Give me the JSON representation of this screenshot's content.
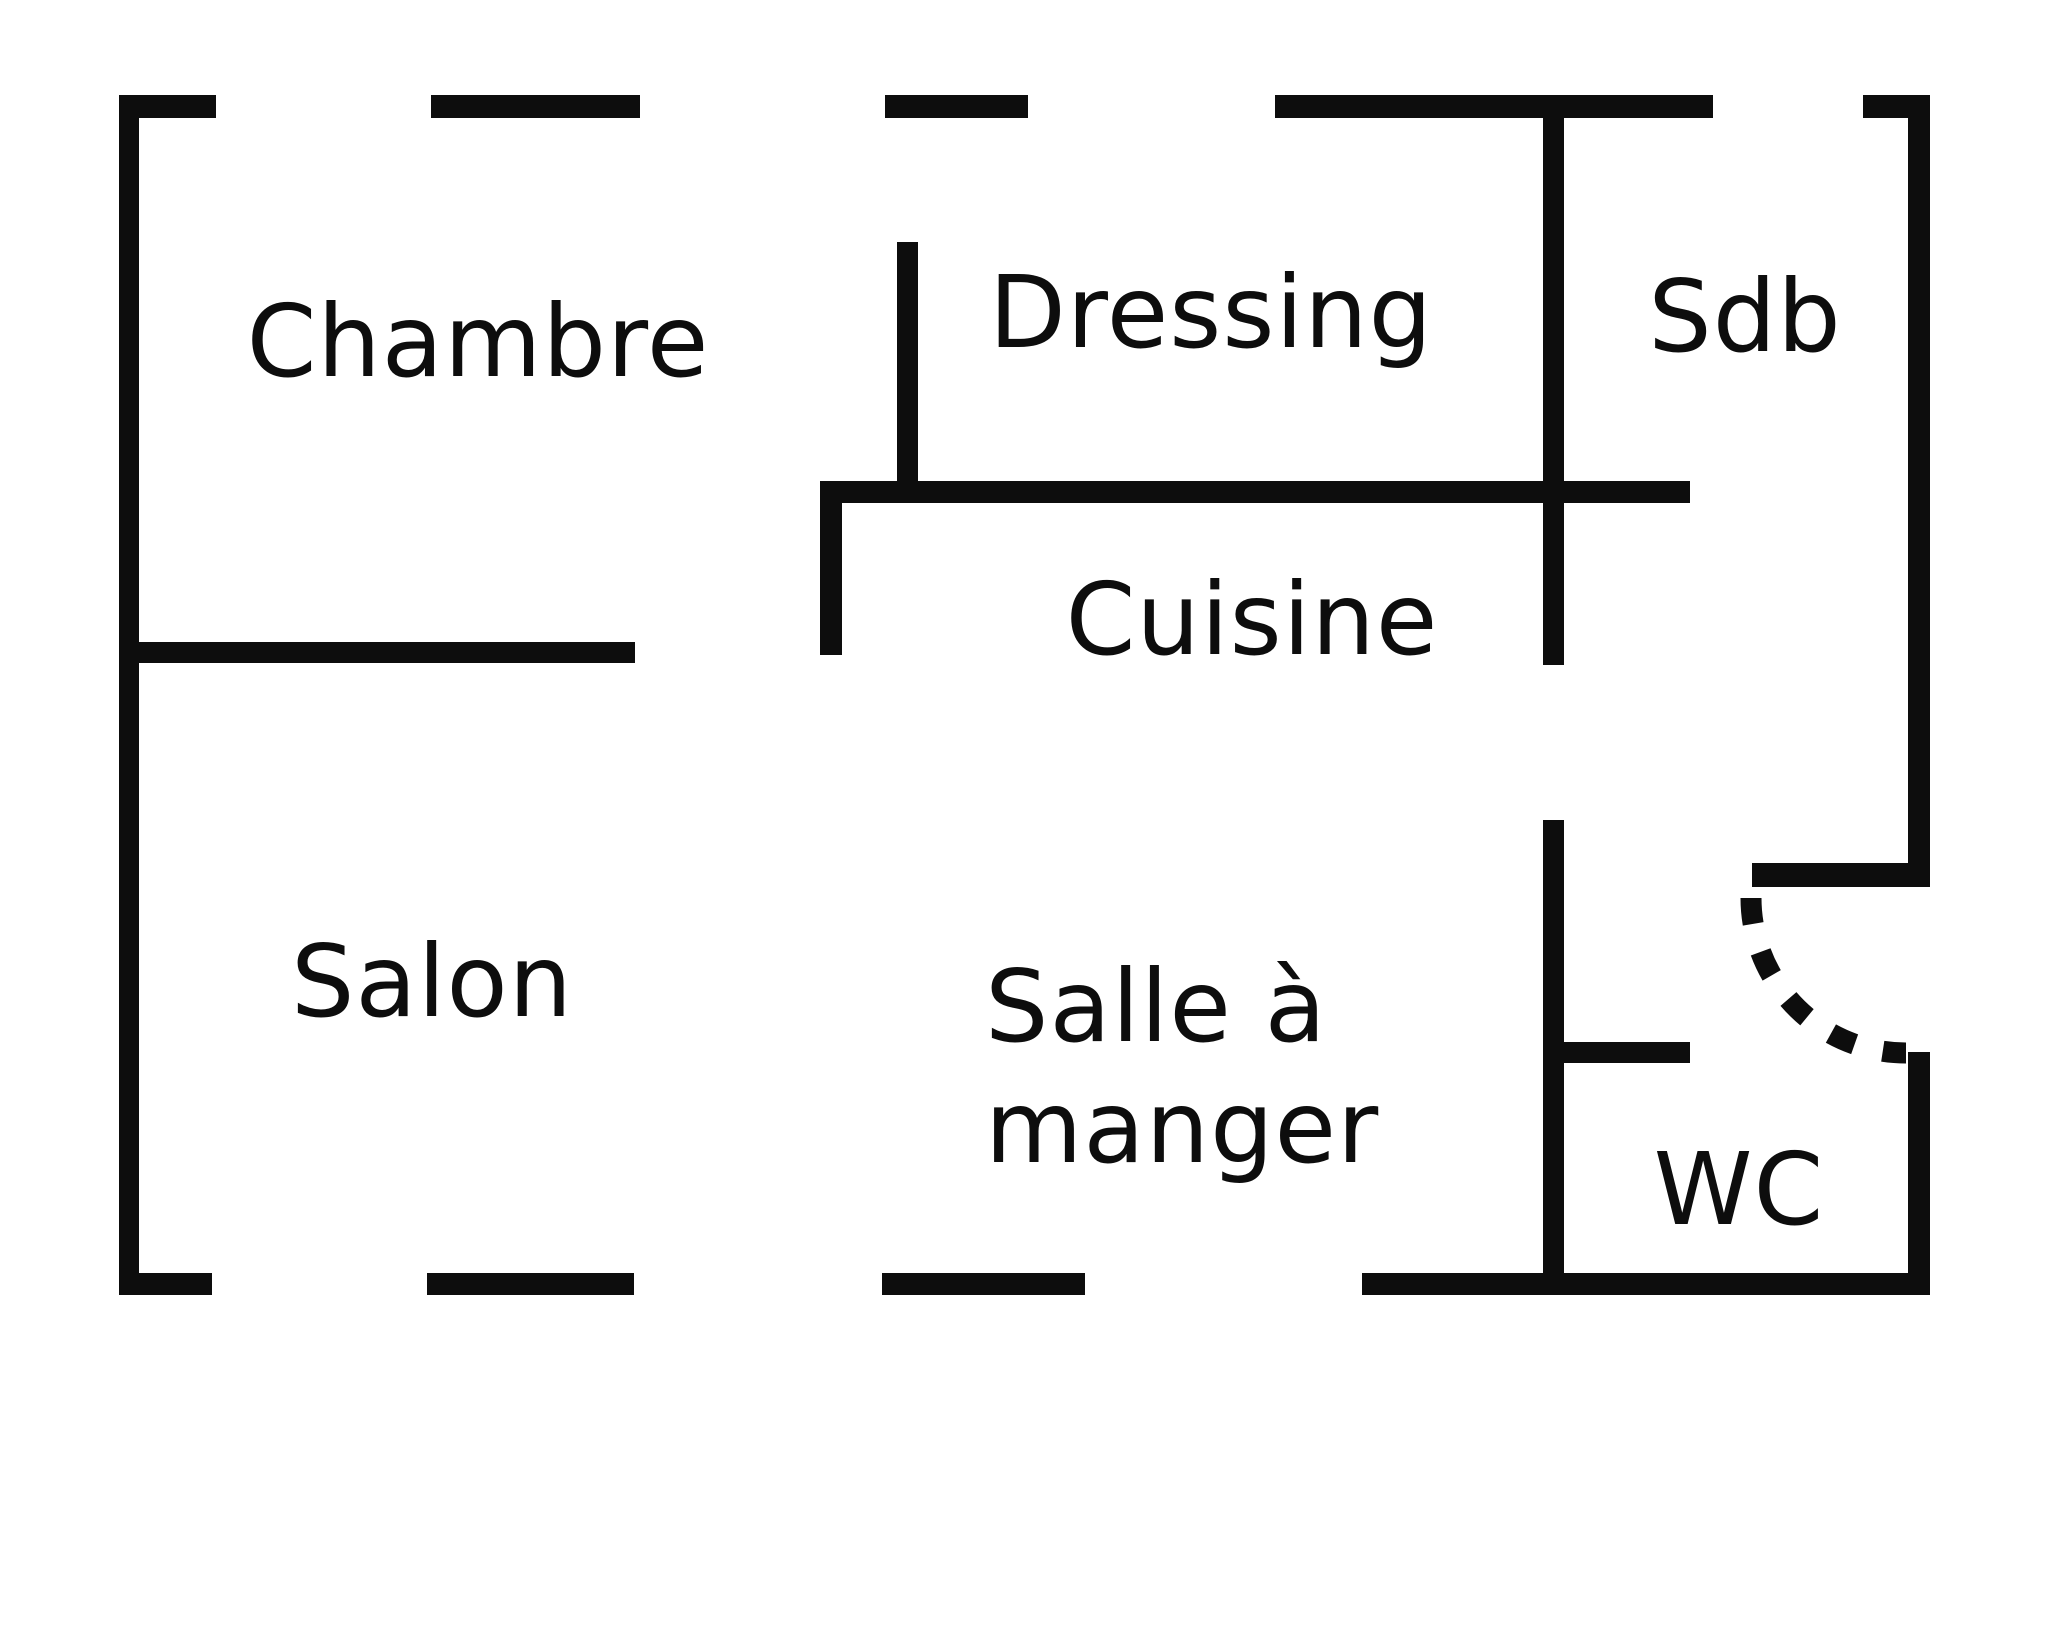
{
  "colors": {
    "wall": "#0d0d0d",
    "background": "#ffffff",
    "label_text": "#0d0d0d"
  },
  "rooms": [
    {
      "id": "chambre",
      "label": "Chambre"
    },
    {
      "id": "dressing",
      "label": "Dressing"
    },
    {
      "id": "sdb",
      "label": "Sdb"
    },
    {
      "id": "cuisine",
      "label": "Cuisine"
    },
    {
      "id": "salon",
      "label": "Salon"
    },
    {
      "id": "salle-a-manger",
      "label": "Salle à manger"
    },
    {
      "id": "wc",
      "label": "WC"
    }
  ]
}
